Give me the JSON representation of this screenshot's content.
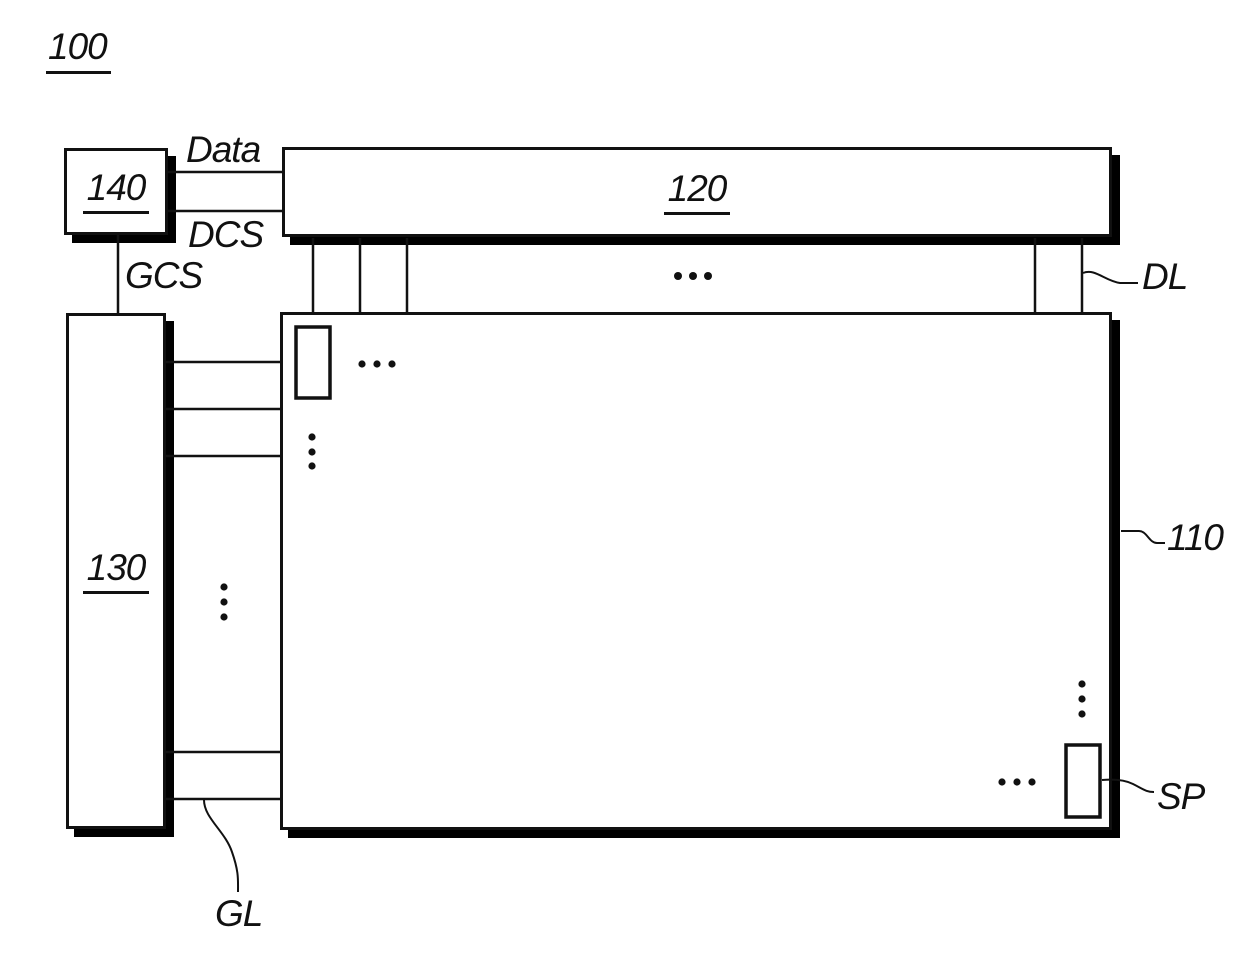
{
  "figure": {
    "number": "100",
    "blocks": {
      "display_panel": {
        "ref": "110"
      },
      "data_driver": {
        "ref": "120"
      },
      "gate_driver": {
        "ref": "130"
      },
      "timing_controller": {
        "ref": "140"
      }
    },
    "signals": {
      "data": "Data",
      "dcs": "DCS",
      "gcs": "GCS"
    },
    "lines": {
      "data_line": "DL",
      "gate_line": "GL",
      "subpixel": "SP"
    },
    "colors": {
      "ink": "#111111",
      "background": "#ffffff"
    }
  }
}
